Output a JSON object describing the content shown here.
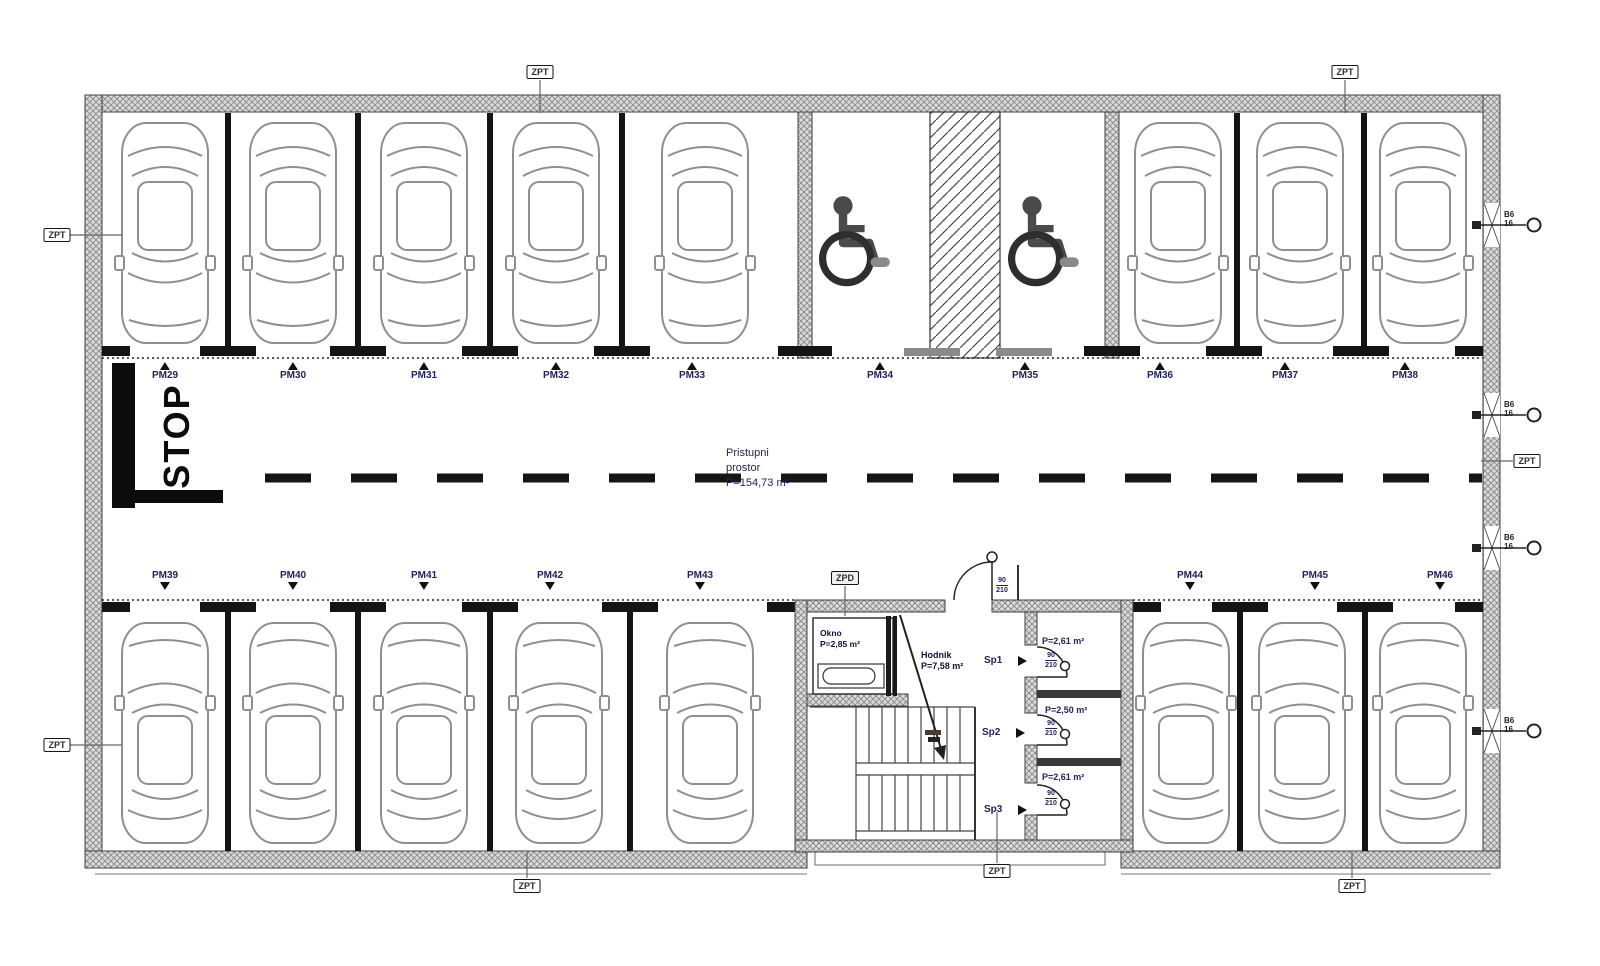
{
  "parking": {
    "top_row": [
      "PM29",
      "PM30",
      "PM31",
      "PM32",
      "PM33",
      "PM34",
      "PM35",
      "PM36",
      "PM37",
      "PM38"
    ],
    "bottom_row": [
      "PM39",
      "PM40",
      "PM41",
      "PM42",
      "PM43",
      "PM44",
      "PM45",
      "PM46"
    ]
  },
  "aisle": {
    "name_line1": "Pristupni",
    "name_line2": "prostor",
    "area": "P=154,73 m²"
  },
  "stop_sign": "STOP",
  "rooms": {
    "okno": {
      "name": "Okno",
      "area": "P=2,85 m²"
    },
    "hodnik": {
      "name": "Hodnik",
      "area": "P=7,58 m²"
    },
    "sp1": {
      "name": "Sp1",
      "area": "P=2,61 m²"
    },
    "sp2": {
      "name": "Sp2",
      "area": "P=2,50 m²"
    },
    "sp3": {
      "name": "Sp3",
      "area": "P=2,61 m²"
    }
  },
  "doors": {
    "width": "90",
    "height": "210"
  },
  "markers": {
    "zpt": "ZPT",
    "zpd": "ZPD",
    "vent_top": "B6",
    "vent_bottom": "16"
  },
  "colors": {
    "wall": "#d9d9d9",
    "wall_hatch": "#8f8f8f",
    "car_line": "#8f8f8f",
    "label": "#232358"
  }
}
